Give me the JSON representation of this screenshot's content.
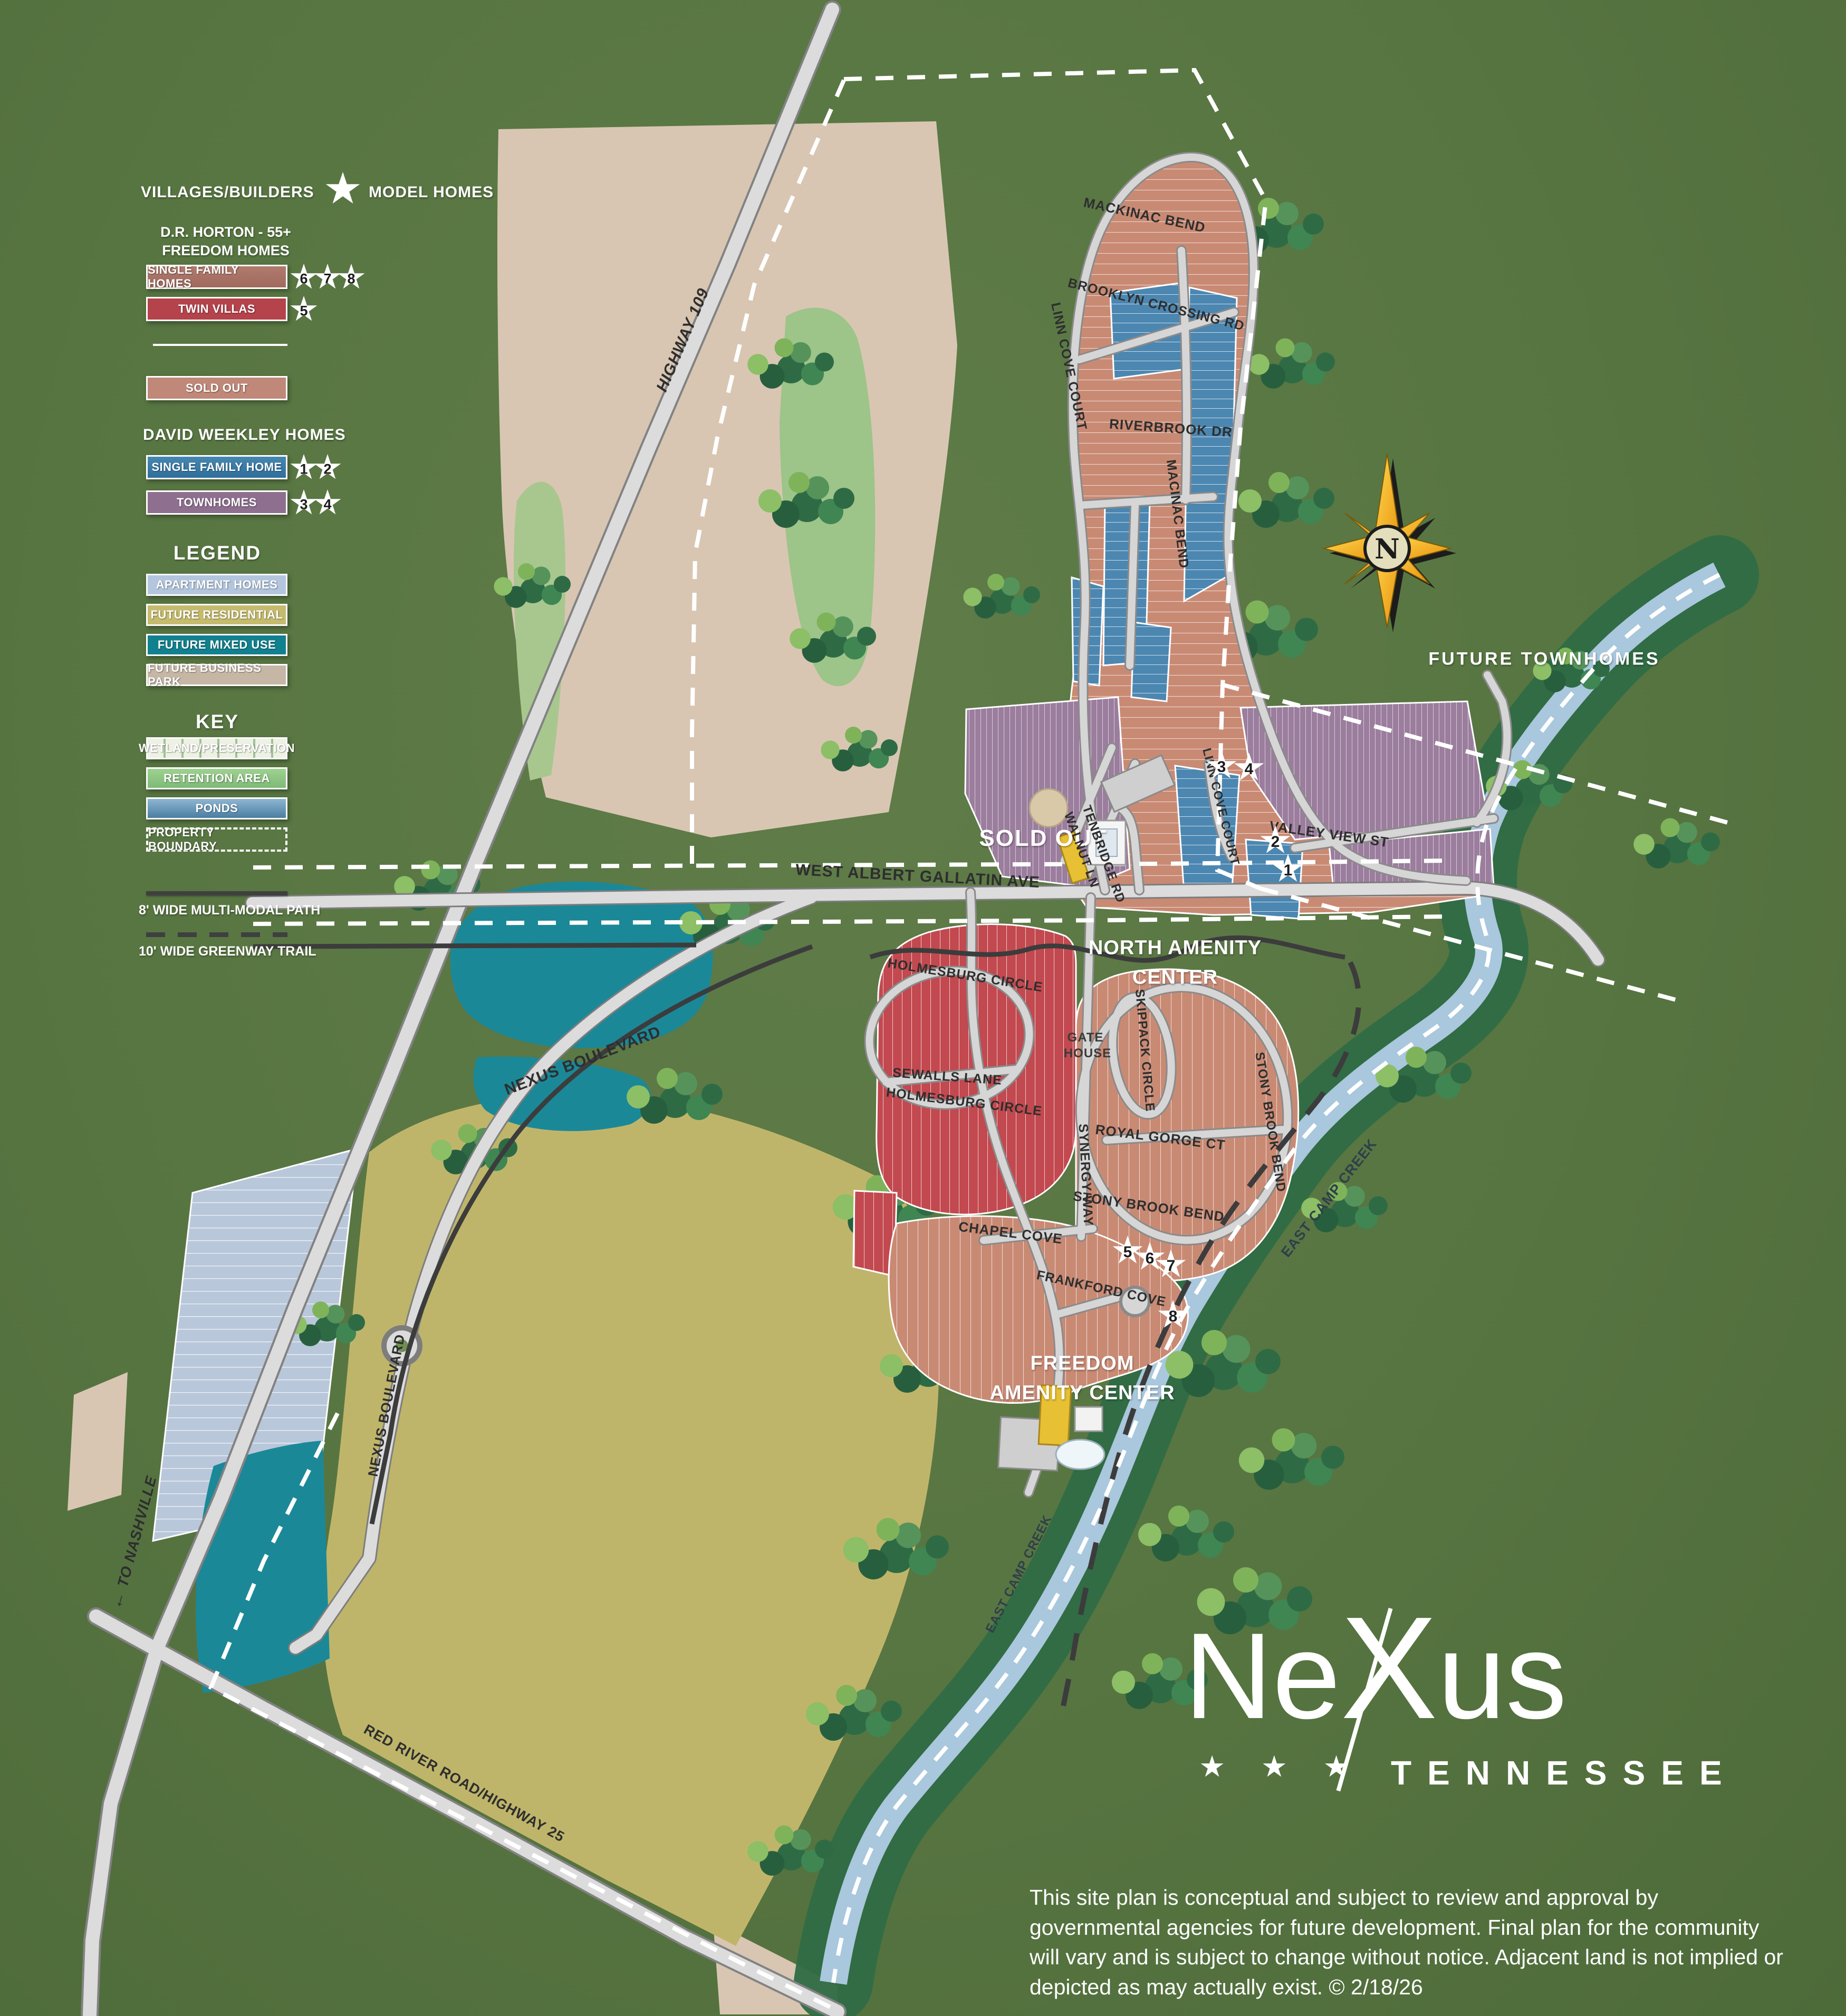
{
  "legend": {
    "villages_builders": "VILLAGES/BUILDERS",
    "model_homes": "MODEL HOMES",
    "dr_horton": {
      "line1": "D.R. HORTON - 55+",
      "line2": "FREEDOM HOMES",
      "items": [
        {
          "label": "SINGLE FAMILY HOMES",
          "stars": [
            "6",
            "7",
            "8"
          ],
          "color": "#a97466"
        },
        {
          "label": "TWIN VILLAS",
          "stars": [
            "5"
          ],
          "color": "#b5434b"
        }
      ]
    },
    "sold_out_label": "SOLD OUT",
    "david_weekley": {
      "title": "DAVID WEEKLEY HOMES",
      "items": [
        {
          "label": "SINGLE FAMILY HOME",
          "stars": [
            "1",
            "2"
          ],
          "color": "#3a7aa6"
        },
        {
          "label": "TOWNHOMES",
          "stars": [
            "3",
            "4"
          ],
          "color": "#8f6f90"
        }
      ]
    },
    "legend_title": "LEGEND",
    "legend_items": [
      "APARTMENT HOMES",
      "FUTURE RESIDENTIAL",
      "FUTURE MIXED USE",
      "FUTURE BUSINESS PARK"
    ],
    "key_title": "KEY",
    "key_items": [
      "WETLAND/PRESERVATION",
      "RETENTION AREA",
      "PONDS",
      "PROPERTY BOUNDARY"
    ],
    "path_labels": {
      "multi_modal": "8' WIDE MULTI-MODAL PATH",
      "greenway": "10' WIDE GREENWAY TRAIL"
    }
  },
  "map": {
    "compass_n": "N",
    "labels": {
      "highway_109": "HIGHWAY 109",
      "to_nashville": "TO NASHVILLE",
      "to_nashville_arrow": "←",
      "red_river_road": "RED RIVER ROAD/HIGHWAY 25",
      "west_albert": "WEST ALBERT GALLATIN AVE",
      "nexus_blvd": "NEXUS BOULEVARD",
      "future_townhomes": "FUTURE  TOWNHOMES",
      "sold_out": "SOLD OUT",
      "north_amenity_1": "NORTH AMENITY",
      "north_amenity_2": "CENTER",
      "freedom_amenity_1": "FREEDOM",
      "freedom_amenity_2": "AMENITY CENTER",
      "gate_house_1": "GATE",
      "gate_house_2": "HOUSE",
      "east_camp_creek": "EAST CAMP CREEK"
    },
    "streets": {
      "mackinac_bend": "MACKINAC BEND",
      "brooklyn_crossing_rd": "BROOKLYN  CROSSING RD",
      "linn_cove_court": "LINN COVE COURT",
      "riverbrook_dr": "RIVERBROOK DR",
      "macinac_bend": "MACINAC BEND",
      "walnut_ln": "WALNUT LN",
      "tenbridge_rd": "TENBRIDGE RD",
      "valley_view_st": "VALLEY VIEW ST",
      "stony_brook_bend": "STONY BROOK BEND",
      "skippack_circle": "SKIPPACK CIRCLE",
      "synergy_way": "SYNERGY WAY",
      "royal_gorge_ct": "ROYAL GORGE CT",
      "chapel_cove": "CHAPEL COVE",
      "holmesburg_circle": "HOLMESBURG CIRCLE",
      "sewalls_lane": "SEWALLS  LANE",
      "frankford_cove": "FRANKFORD  COVE"
    },
    "stars": {
      "s1": "1",
      "s2": "2",
      "s3": "3",
      "s4": "4",
      "s5": "5",
      "s6": "6",
      "s7": "7",
      "s8": "8"
    }
  },
  "logo": {
    "part1": "Ne",
    "part2": "X",
    "part3": "us",
    "stars": "★ ★ ★",
    "state": "TENNESSEE"
  },
  "disclaimer": "This site plan is conceptual and subject to review and approval by governmental agencies for future development. Final plan for the community will vary and is subject to change without notice. Adjacent land is not implied or depicted as may actually exist.  © 2/18/26",
  "colors": {
    "background_green": "#577541",
    "future_business_park_tan": "#d8c6b2",
    "future_residential_khaki": "#bfb56a",
    "apartment_blue_gray": "#b9c7da",
    "pond_teal": "#1b8898",
    "creek_blue": "#a9c7dd",
    "single_family_salmon": "#c98a74",
    "twin_villa_red": "#c2494f",
    "dw_single_family_blue": "#4c87b1",
    "townhome_purple": "#9b7d9d",
    "road_gray": "#dcdcdc",
    "compass_gold": "#f2b415"
  }
}
